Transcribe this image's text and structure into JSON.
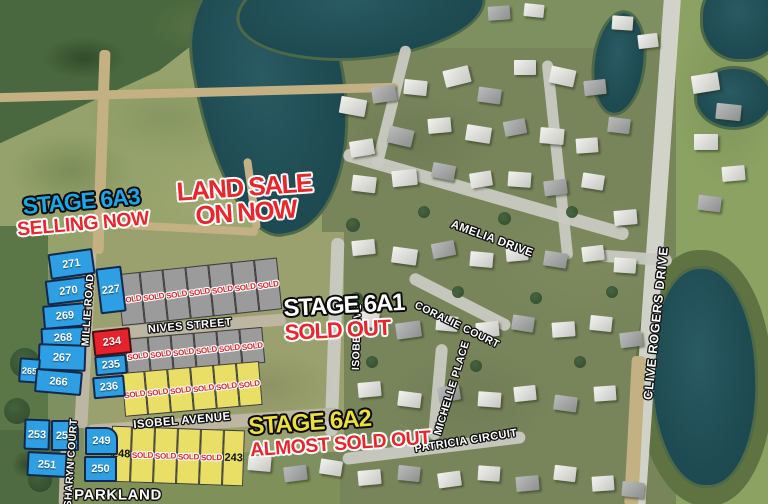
{
  "banners": {
    "stage_6a3": {
      "title": "STAGE 6A3",
      "subtitle": "SELLING NOW"
    },
    "land_sale": {
      "line1": "LAND SALE",
      "line2": "ON NOW"
    },
    "stage_6a1": {
      "title": "STAGE 6A1",
      "subtitle": "SOLD OUT"
    },
    "stage_6a2": {
      "title": "STAGE 6A2",
      "subtitle": "ALMOST SOLD OUT"
    }
  },
  "streets": {
    "millie_road": "MILLIE ROAD",
    "nives_street": "NIVES STREET",
    "isobel_avenue": "ISOBEL AVENUE",
    "isobel_ave_vertical": "ISOBEL AVE",
    "sharyn_court": "SHARYN COURT",
    "amelia_drive": "AMELIA DRIVE",
    "coralie_court": "CORALIE COURT",
    "michelle_place": "MICHELLE PLACE",
    "patricia_circuit": "PATRICIA CIRCUIT",
    "clive_rogers_drive": "CLIVE ROGERS DRIVE"
  },
  "areas": {
    "parkland": "PARKLAND"
  },
  "lots": {
    "west_column": [
      "271",
      "270",
      "269",
      "268",
      "267",
      "266"
    ],
    "lot_265": "265",
    "lot_227": "227",
    "lot_234": "234",
    "lot_235": "235",
    "lot_236": "236",
    "row_nives_north": [
      "SOLD",
      "SOLD",
      "SOLD",
      "SOLD",
      "SOLD",
      "SOLD",
      "SOLD"
    ],
    "row_nives_south": [
      "SOLD",
      "SOLD",
      "SOLD",
      "SOLD",
      "SOLD",
      "SOLD"
    ],
    "row_isobel_north": [
      "SOLD",
      "SOLD",
      "SOLD",
      "SOLD",
      "SOLD",
      "SOLD"
    ],
    "row_isobel_south": [
      "248",
      "SOLD",
      "SOLD",
      "SOLD",
      "SOLD",
      "243"
    ],
    "block_sharyn_west": [
      "253",
      "252",
      "251"
    ],
    "block_sharyn_east": [
      "249",
      "250"
    ]
  },
  "colors": {
    "available_blue": "#2d9fe2",
    "featured_red": "#e6222c",
    "sold_gray": "#9b9b9b",
    "sold_yellow": "#e9df66",
    "sold_text_red": "#d8262b",
    "stage_6a3_blue": "#1ca6e8",
    "stage_6a2_yellow": "#eadf3e",
    "status_red": "#e8262d"
  }
}
